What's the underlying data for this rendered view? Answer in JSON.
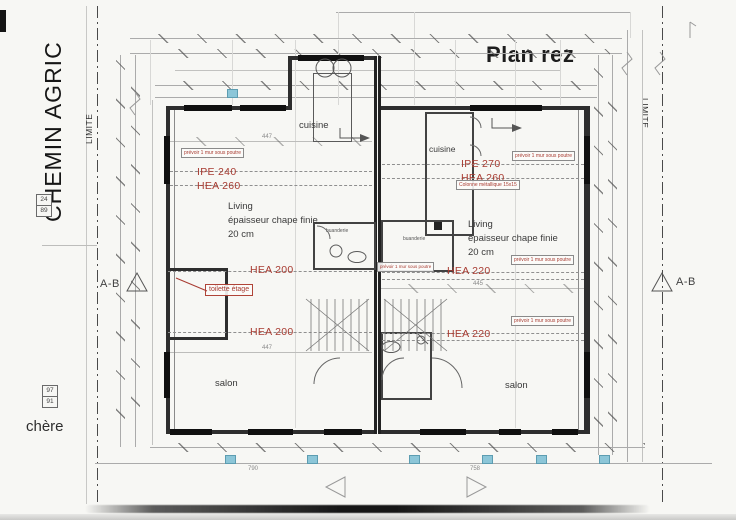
{
  "page": {
    "title": "Plan rez",
    "road_label": "CHEMIN AGRIC",
    "limit_left": "LIMITE",
    "limit_right": "LIMITE",
    "bottom_left_text": "chère",
    "section_left": "A-B",
    "section_right": "A-B",
    "ref_box_top": {
      "a": "24",
      "b": "89"
    },
    "ref_box_bottom": {
      "a": "97",
      "b": "91"
    }
  },
  "rooms": {
    "kitchen_left": "cuisine",
    "kitchen_right": "cuisine",
    "living_line1": "Living",
    "living_line2": "épaisseur chape finie",
    "living_line3": "20 cm",
    "salon": "salon",
    "laundry": "buanderie"
  },
  "beams": {
    "ipe240": "IPE 240",
    "hea260": "HEA 260",
    "ipe270": "IPE 270",
    "hea260_r": "HEA 260",
    "hea200": "HEA 200",
    "hea220": "HEA 220"
  },
  "notes": {
    "wall_under_beam": "prévoir 1 mur sous poutre",
    "column": "Colonne métallique 15x15",
    "toilet_upstairs": "toilette étage"
  },
  "dims": {
    "d447": "447",
    "d445": "445",
    "d790": "790",
    "d758": "758"
  },
  "colors": {
    "annotation_red": "#a83b31",
    "highlight_cyan": "#8cc6d8"
  }
}
